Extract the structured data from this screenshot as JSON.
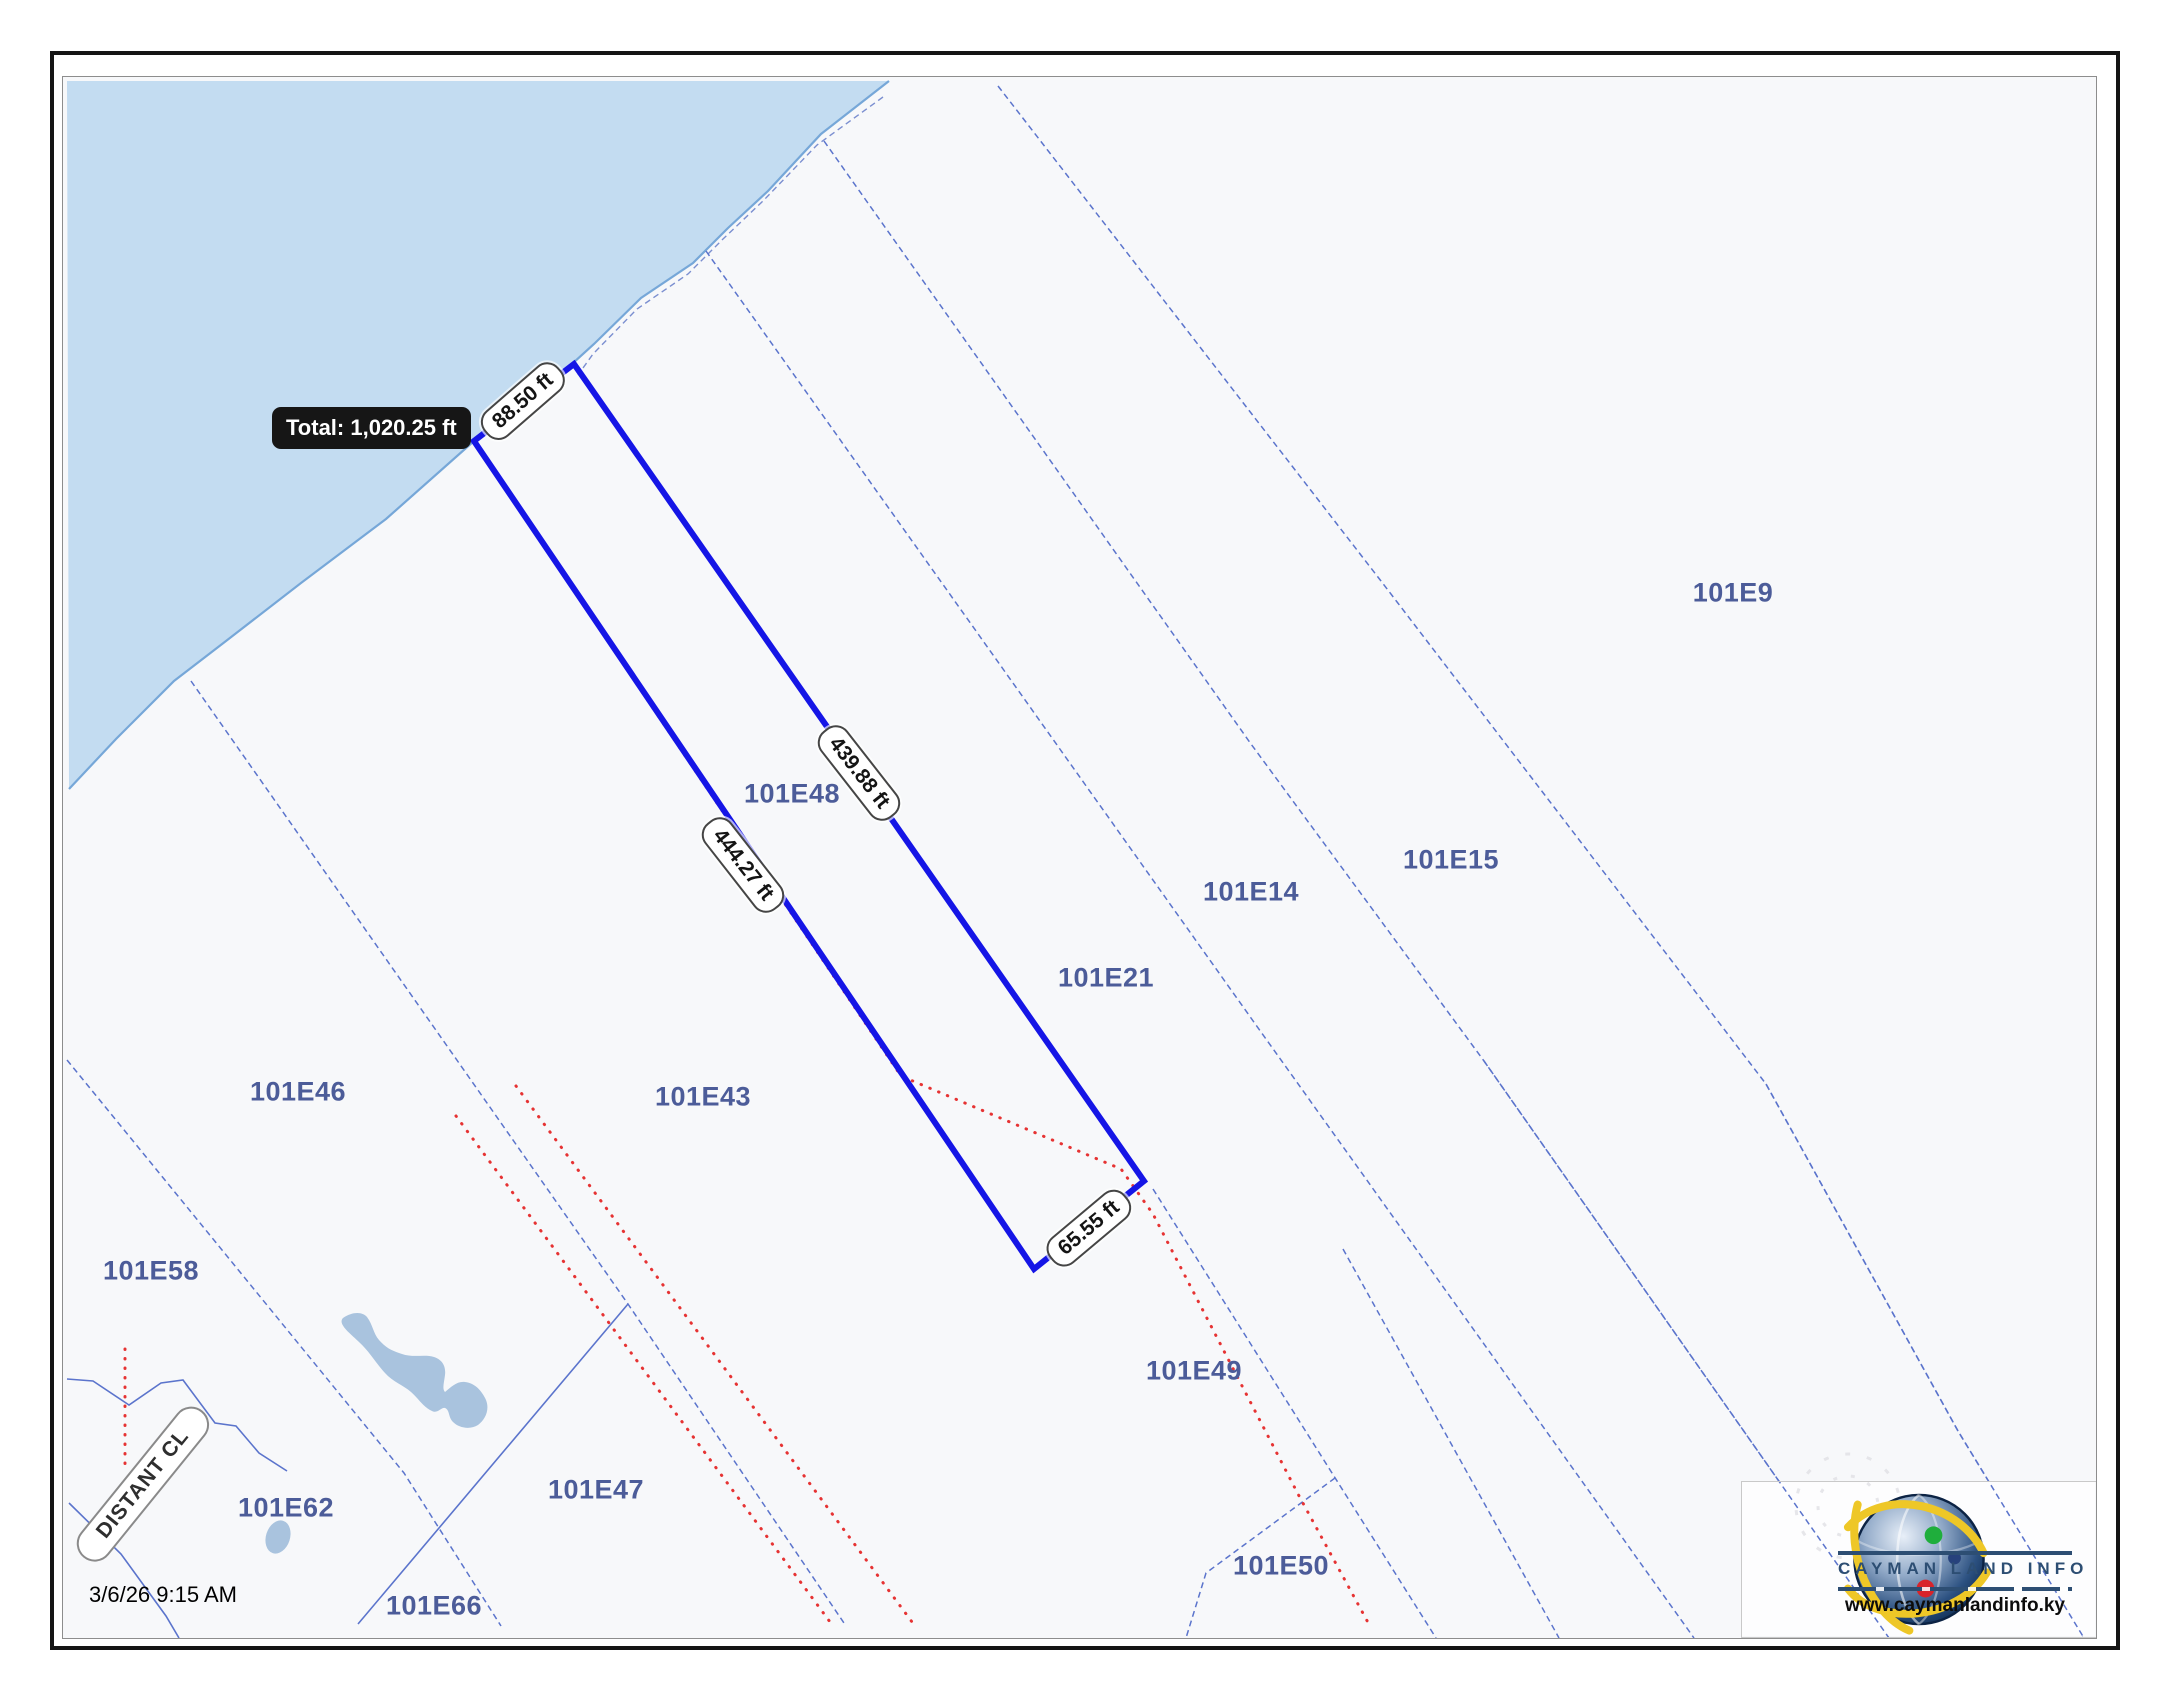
{
  "header": {
    "timestamp": "3/6/26 9:15 AM"
  },
  "measurement_tool": {
    "tooltip_total": "Total: 1,020.25 ft",
    "segments": [
      {
        "side": "shore-edge",
        "label": "88.50 ft"
      },
      {
        "side": "north-east-edge",
        "label": "439.88 ft"
      },
      {
        "side": "south-west-edge",
        "label": "444.27 ft"
      },
      {
        "side": "bottom-edge",
        "label": "65.55 ft"
      }
    ]
  },
  "map": {
    "selected_parcel": "101E48",
    "road_label": "DISTANT CL",
    "parcel_labels": [
      {
        "id": "101E9"
      },
      {
        "id": "101E15"
      },
      {
        "id": "101E14"
      },
      {
        "id": "101E21"
      },
      {
        "id": "101E48"
      },
      {
        "id": "101E43"
      },
      {
        "id": "101E46"
      },
      {
        "id": "101E58"
      },
      {
        "id": "101E62"
      },
      {
        "id": "101E66"
      },
      {
        "id": "101E47"
      },
      {
        "id": "101E49"
      },
      {
        "id": "101E50"
      }
    ]
  },
  "branding": {
    "name": "CAYMAN LAND INFO",
    "website": "www.caymanlandinfo.ky"
  },
  "colors": {
    "map_background": "#f7f8fa",
    "water": "#c3dcf1",
    "shoreline": "#76a7d8",
    "parcel_line": "#5b74cc",
    "selected_outline": "#1515e6",
    "survey_red": "#e63333",
    "parcel_label": "#4c5c99",
    "tooltip_background": "#161616",
    "brand_navy": "#2d4e73",
    "pond": "#a9c3de"
  }
}
